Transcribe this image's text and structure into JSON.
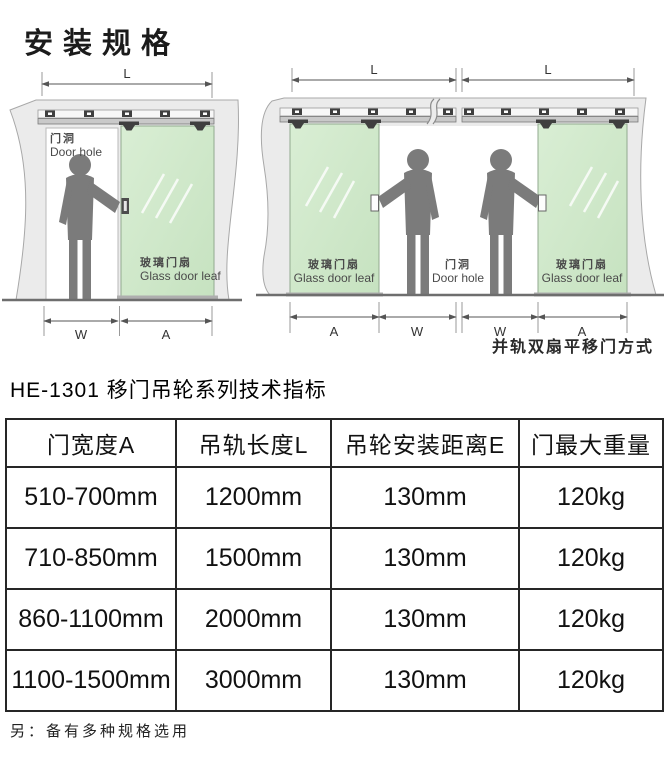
{
  "page": {
    "title": "安装规格"
  },
  "diagrams": {
    "single": {
      "dim_l": "L",
      "dim_w": "W",
      "dim_a": "A",
      "door_hole_cn": "门洞",
      "door_hole_en": "Door hole",
      "glass_cn": "玻璃门扇",
      "glass_en": "Glass door leaf"
    },
    "double": {
      "dim_l_left": "L",
      "dim_l_right": "L",
      "dims_bottom": [
        "A",
        "W",
        "W",
        "A"
      ],
      "glass_left_cn": "玻璃门扇",
      "glass_left_en": "Glass door leaf",
      "door_hole_cn": "门洞",
      "door_hole_en": "Door hole",
      "glass_right_cn": "玻璃门扇",
      "glass_right_en": "Glass door leaf",
      "caption": "并轨双扇平移门方式"
    }
  },
  "spec": {
    "title": "HE-1301  移门吊轮系列技术指标",
    "table": {
      "headers": [
        "门宽度A",
        "吊轨长度L",
        "吊轮安装距离E",
        "门最大重量"
      ],
      "rows": [
        [
          "510-700mm",
          "1200mm",
          "130mm",
          "120kg"
        ],
        [
          "710-850mm",
          "1500mm",
          "130mm",
          "120kg"
        ],
        [
          "860-1100mm",
          "2000mm",
          "130mm",
          "120kg"
        ],
        [
          "1100-1500mm",
          "3000mm",
          "130mm",
          "120kg"
        ]
      ]
    },
    "note": "另：备有多种规格选用"
  },
  "colors": {
    "wall": "#ebebeb",
    "glass_door": "#cfe8c9",
    "figure": "#7b7b7b",
    "rail": "#c9c9c9",
    "table_border": "#262626",
    "text": "#1b1b1b"
  }
}
